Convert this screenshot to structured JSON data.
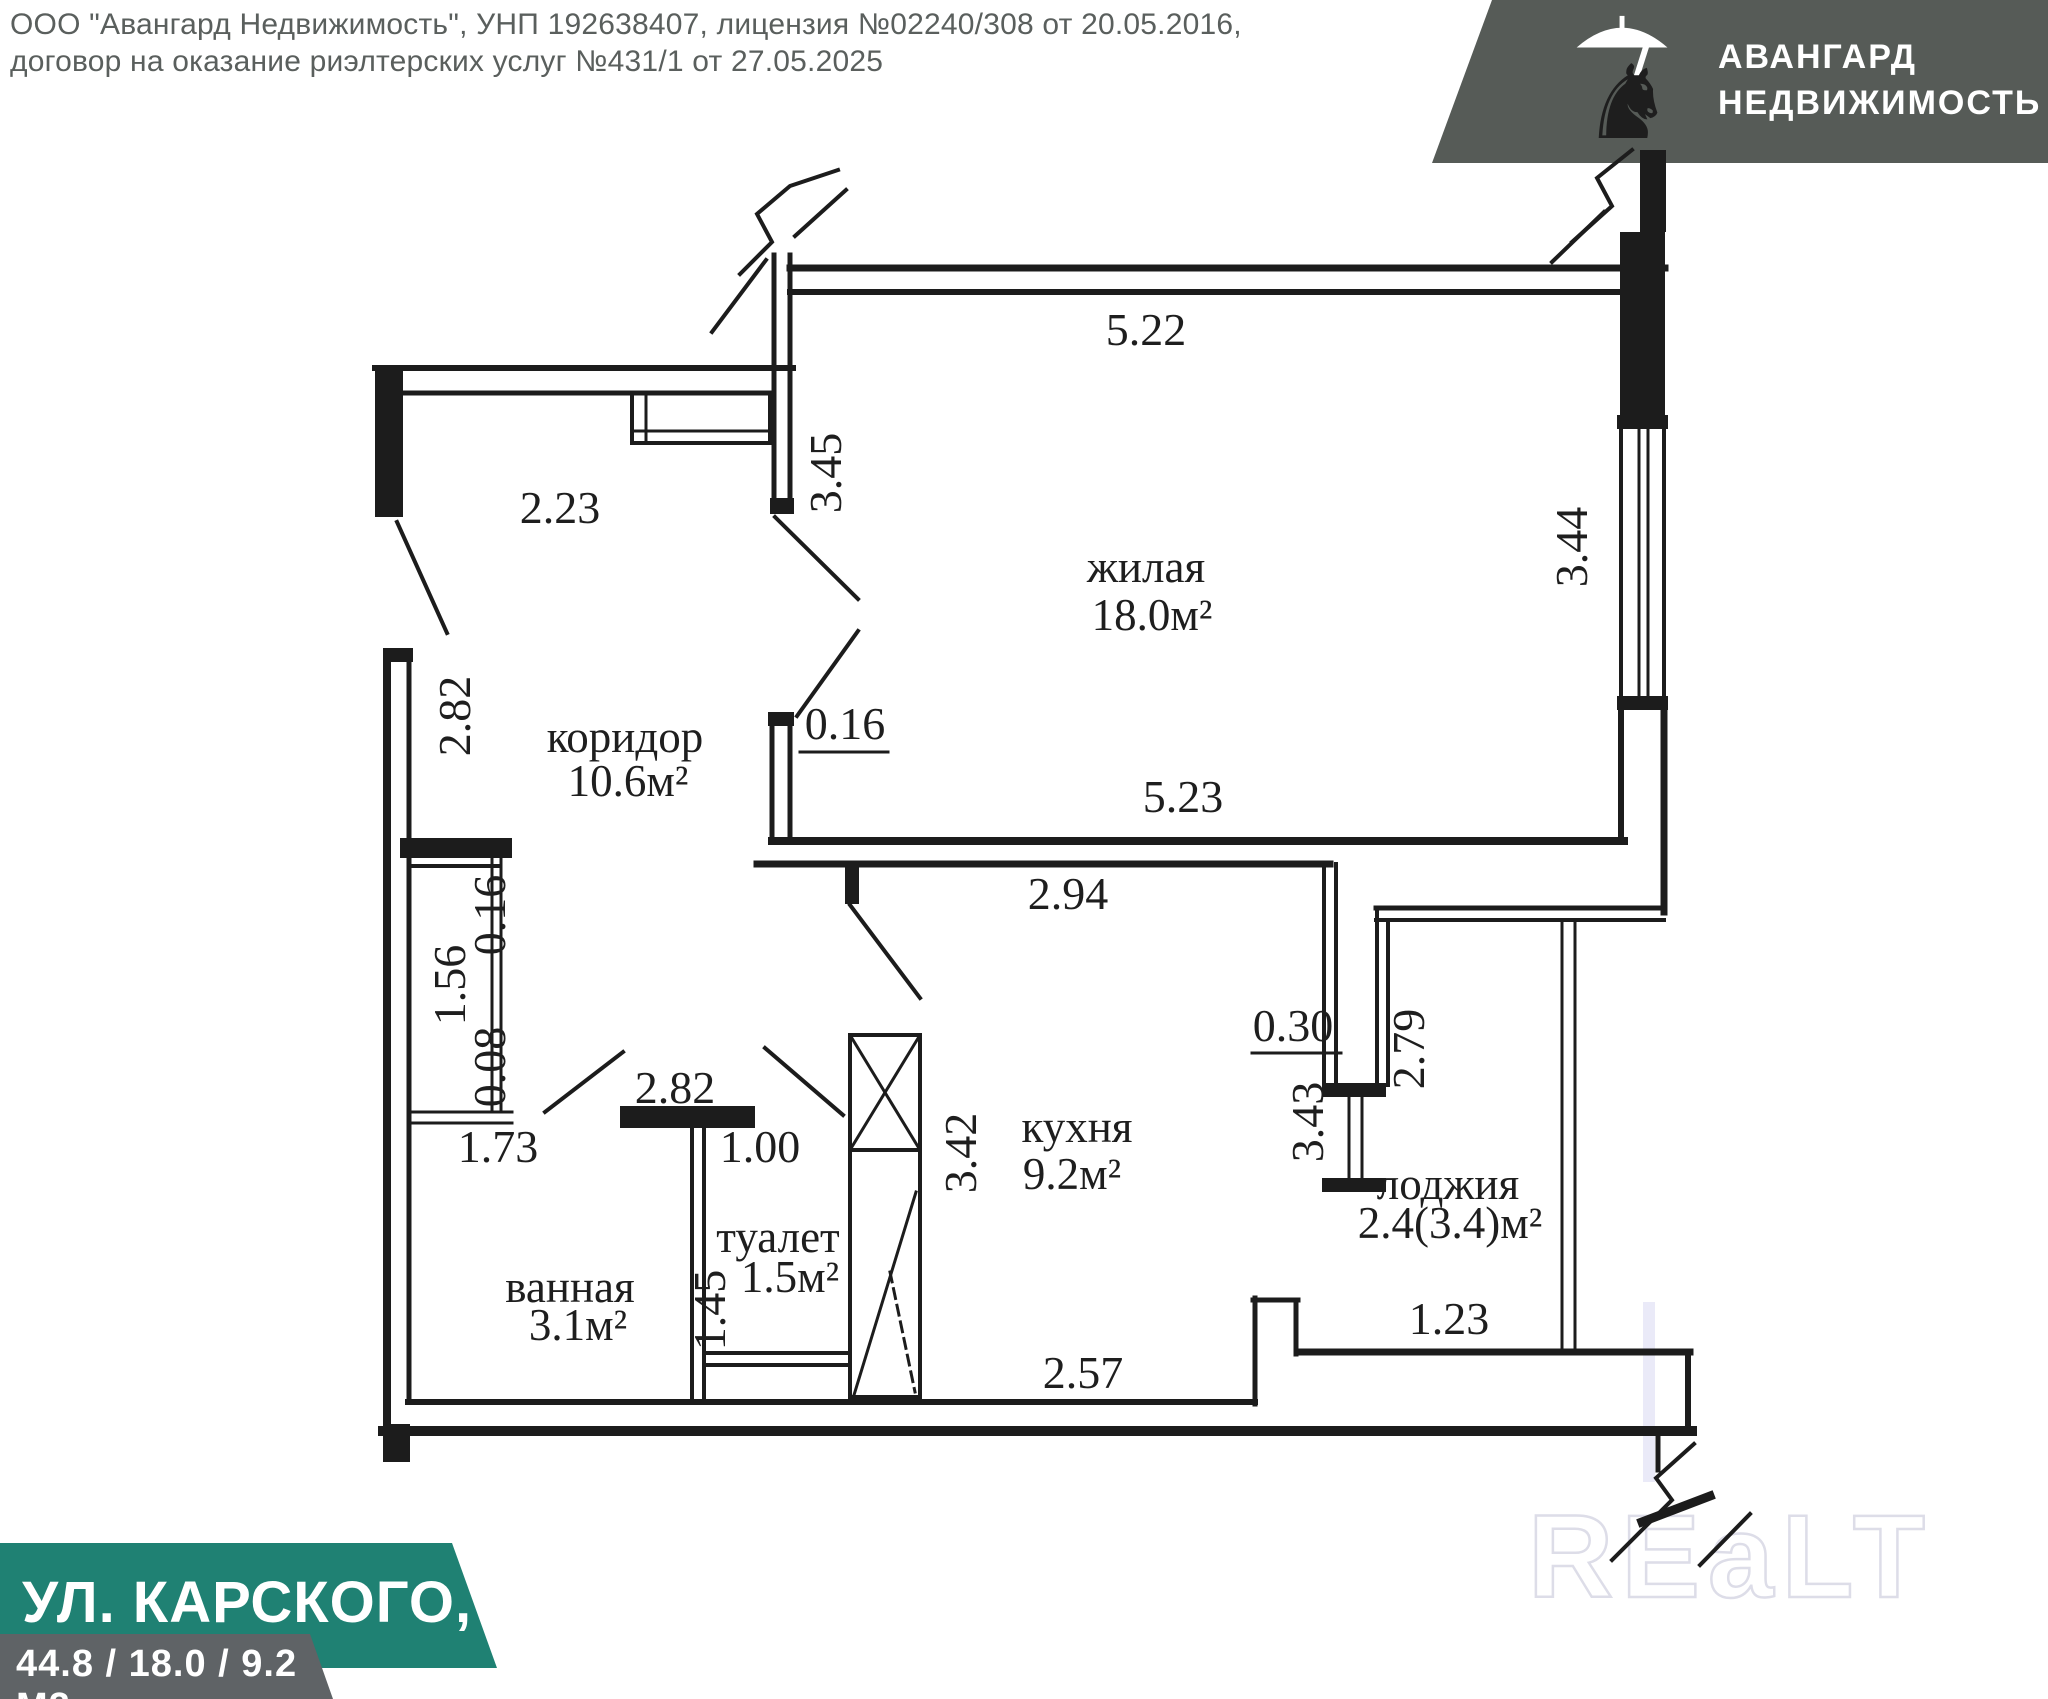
{
  "header": {
    "line1": "ООО \"Авангард Недвижимость\", УНП 192638407, лицензия №02240/308 от 20.05.2016,",
    "line2": "договор на оказание риэлтерских услуг №431/1 от 27.05.2025"
  },
  "logo": {
    "brand_line1": "АВАНГАРД",
    "brand_line2": "НЕДВИЖИМОСТЬ",
    "bg_color": "#565b57",
    "icon": "knight-with-umbrella"
  },
  "address_banner": {
    "text": "УЛ. КАРСКОГО, 48",
    "bg_color": "#1f8173"
  },
  "areas_banner": {
    "text": "44.8 / 18.0 / 9.2 М2",
    "bg_color": "#5f6366"
  },
  "watermark": {
    "text": "REaLT"
  },
  "plan": {
    "line_color": "#1c1c1c",
    "rooms": [
      {
        "name": "жилая",
        "area": "18.0м²"
      },
      {
        "name": "коридор",
        "area": "10.6м²"
      },
      {
        "name": "кухня",
        "area": "9.2м²"
      },
      {
        "name": "ванная",
        "area": "3.1м²"
      },
      {
        "name": "туалет",
        "area": "1.5м²"
      },
      {
        "name": "лоджия",
        "area": "2.4(3.4)м²"
      }
    ],
    "dimensions": [
      "5.22",
      "3.45",
      "2.23",
      "2.82",
      "0.16",
      "5.23",
      "2.94",
      "3.44",
      "0.16",
      "1.56",
      "0.08",
      "2.82",
      "1.73",
      "1.00",
      "3.42",
      "0.30",
      "3.43",
      "2.79",
      "1.45",
      "1.23",
      "2.57"
    ]
  }
}
